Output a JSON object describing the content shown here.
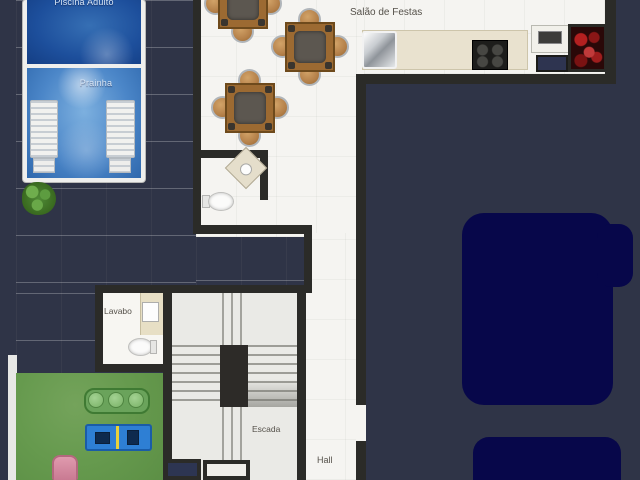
{
  "title": "Salão de Festas - planta baixa",
  "labels": {
    "pool_adult": "Piscina Adulto",
    "pool_kids": "Prainha",
    "party_hall": "Salão de Festas",
    "washroom": "Lavabo",
    "stairs": "Escada",
    "hall": "Hall"
  },
  "colors": {
    "background": "#2f3447",
    "wall": "#2b2b28",
    "deck": "#c7c7c5",
    "floor": "#f5f4f1",
    "grass": "#669a4e",
    "pool_adult": "#1c55a0",
    "pool_kids": "#4785c8",
    "dark_shape": "#07074a",
    "counter": "#e9e2cf",
    "table_wood": "#9c6a32",
    "sofa_green": "#6aa35b",
    "game_table_blue": "#2e7fd4",
    "lounger_pink": "#d282a0"
  }
}
